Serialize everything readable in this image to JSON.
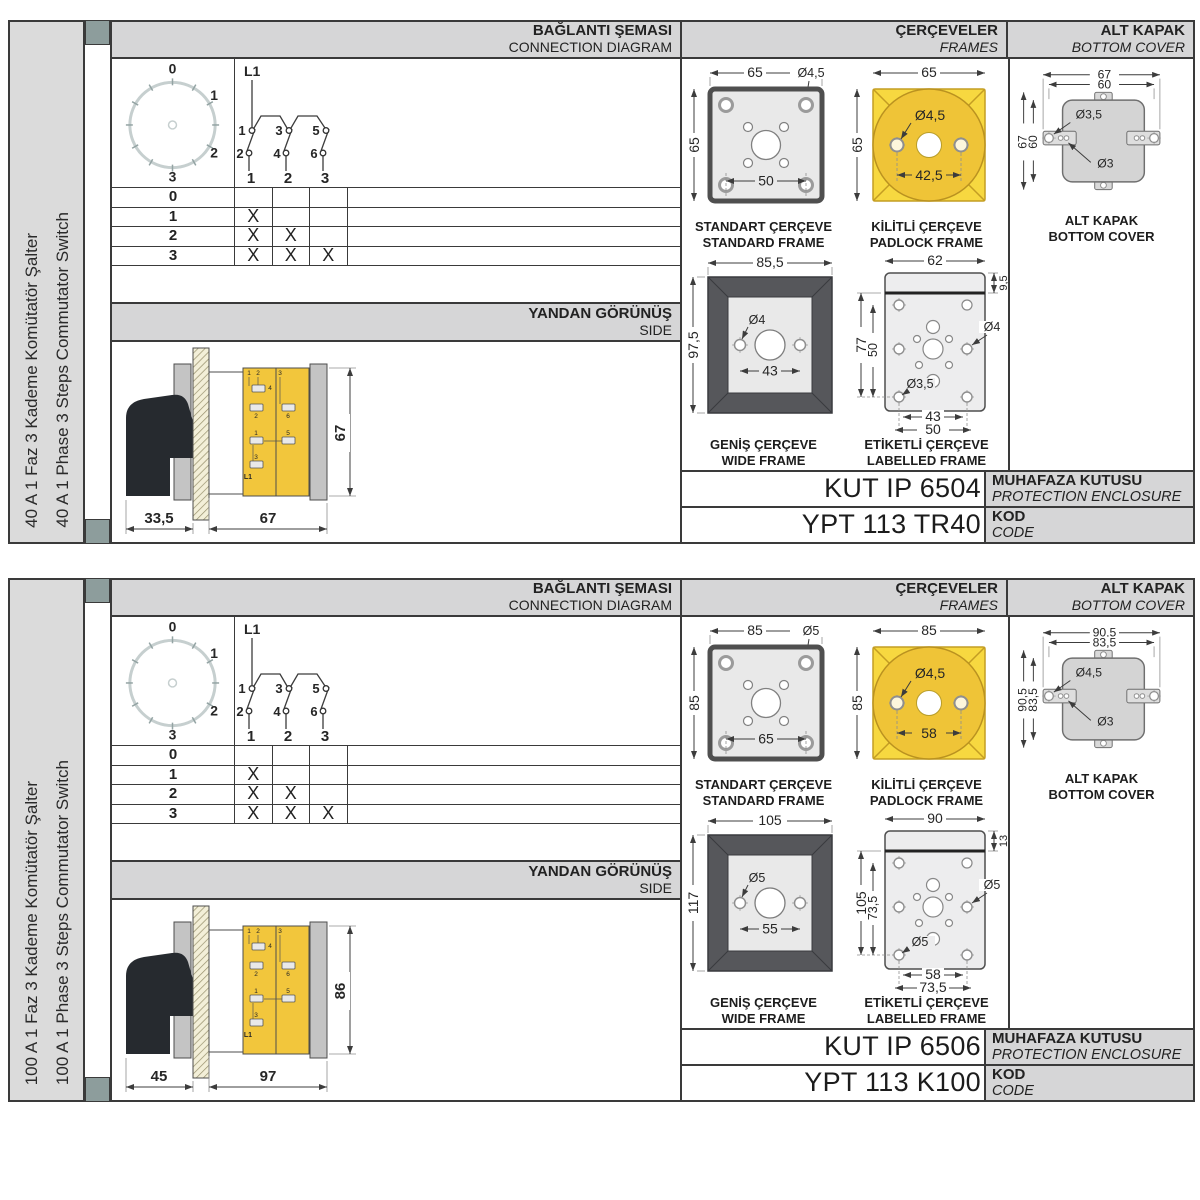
{
  "shared": {
    "headers": {
      "connection_tr": "BAĞLANTI ŞEMASI",
      "connection_en": "CONNECTION DIAGRAM",
      "frames_tr": "ÇERÇEVELER",
      "frames_en": "FRAMES",
      "cover_tr": "ALT KAPAK",
      "cover_en": "BOTTOM COVER",
      "side_tr": "YANDAN GÖRÜNÜŞ",
      "side_en": "SIDE"
    },
    "dial": {
      "positions": [
        "0",
        "1",
        "2",
        "3"
      ]
    },
    "circuit": {
      "phase": "L1",
      "upper": [
        "1",
        "3",
        "5"
      ],
      "lower": [
        "2",
        "4",
        "6"
      ],
      "outputs": [
        "1",
        "2",
        "3"
      ]
    },
    "table": {
      "rows": [
        {
          "label": "0",
          "m": [
            "",
            "",
            ""
          ]
        },
        {
          "label": "1",
          "m": [
            "X",
            "",
            ""
          ]
        },
        {
          "label": "2",
          "m": [
            "X",
            "X",
            ""
          ]
        },
        {
          "label": "3",
          "m": [
            "X",
            "X",
            "X"
          ]
        }
      ]
    },
    "captions": {
      "standard_tr": "STANDART ÇERÇEVE",
      "standard_en": "STANDARD FRAME",
      "padlock_tr": "KİLİTLİ ÇERÇEVE",
      "padlock_en": "PADLOCK FRAME",
      "wide_tr": "GENİŞ ÇERÇEVE",
      "wide_en": "WIDE FRAME",
      "labelled_tr": "ETİKETLİ ÇERÇEVE",
      "labelled_en": "LABELLED FRAME"
    },
    "enclosure_label_tr": "MUHAFAZA KUTUSU",
    "enclosure_label_en": "PROTECTION ENCLOSURE",
    "code_label_tr": "KOD",
    "code_label_en": "CODE",
    "side_minis": [
      "1",
      "2",
      "4",
      "2",
      "3",
      "6",
      "1",
      "5",
      "3",
      "L1"
    ]
  },
  "sections": [
    {
      "label_tr": "40 A 1 Faz 3 Kademe Komütatör Şalter",
      "label_en": "40 A 1 Phase 3 Steps Commutator Switch",
      "side": {
        "d_front": "33,5",
        "d_body": "67",
        "h": "67"
      },
      "standard": {
        "w": "65",
        "h": "65",
        "s": "50",
        "dia": "Ø4,5"
      },
      "padlock": {
        "w": "65",
        "h": "65",
        "s": "42,5",
        "dia": "Ø4,5"
      },
      "wide": {
        "w": "85,5",
        "h": "97,5",
        "s": "43",
        "dia": "Ø4"
      },
      "labelled": {
        "w": "62",
        "strip": "9,5",
        "h": "77",
        "ih": "50",
        "dia_side": "Ø4",
        "dia_corner": "Ø3,5",
        "s1": "43",
        "s2": "50"
      },
      "cover": {
        "w1": "67",
        "w2": "60",
        "h1": "67",
        "h2": "60",
        "dia1": "Ø3,5",
        "dia2": "Ø3"
      },
      "enclosure": "KUT IP 6504",
      "code": "YPT 113 TR40"
    },
    {
      "label_tr": "100 A 1 Faz 3 Kademe Komütatör Şalter",
      "label_en": "100 A 1 Phase 3 Steps Commutator Switch",
      "side": {
        "d_front": "45",
        "d_body": "97",
        "h": "86"
      },
      "standard": {
        "w": "85",
        "h": "85",
        "s": "65",
        "dia": "Ø5"
      },
      "padlock": {
        "w": "85",
        "h": "85",
        "s": "58",
        "dia": "Ø4,5"
      },
      "wide": {
        "w": "105",
        "h": "117",
        "s": "55",
        "dia": "Ø5"
      },
      "labelled": {
        "w": "90",
        "strip": "13",
        "h": "105",
        "ih": "73,5",
        "dia_side": "Ø5",
        "dia_corner": "Ø5",
        "s1": "58",
        "s2": "73,5"
      },
      "cover": {
        "w1": "90,5",
        "w2": "83,5",
        "h1": "90,5",
        "h2": "83,5",
        "dia1": "Ø4,5",
        "dia2": "Ø3"
      },
      "enclosure": "KUT IP 6506",
      "code": "YPT 113 K100"
    }
  ]
}
